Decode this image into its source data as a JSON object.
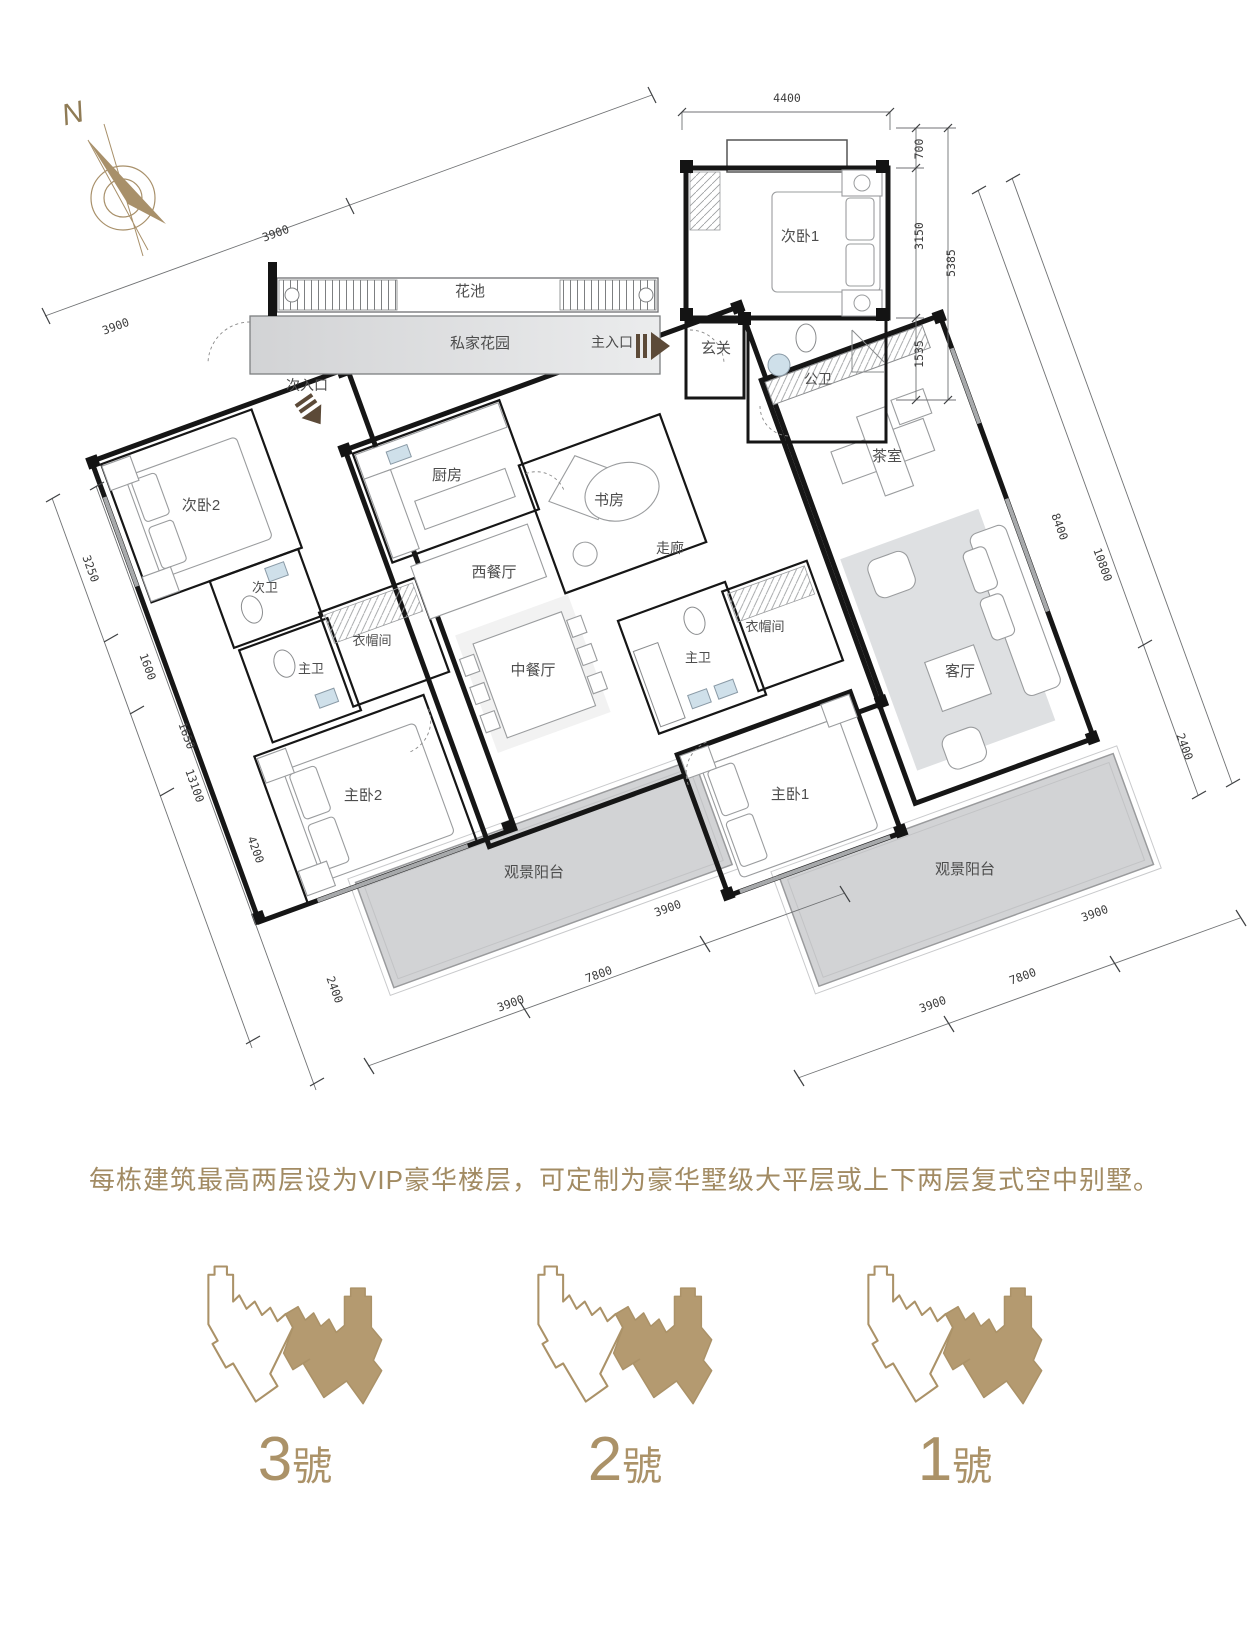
{
  "compass": {
    "label": "N"
  },
  "caption": "每栋建筑最高两层设为VIP豪华楼层，可定制为豪华墅级大平层或上下两层复式空中别墅。",
  "colors": {
    "accent_tan": "#ab9268",
    "entrance_arrow_brown": "#5c4a38",
    "bedroom_floor": "#d8d2c8",
    "bathroom_floor": "#c7cdd3",
    "closet_floor": "#cdc7bc",
    "common_floor": "#e6e7e9",
    "balcony_floor": "#d2d3d5",
    "wall": "#161616"
  },
  "plan": {
    "rooms": [
      {
        "t": "花池",
        "x": 470,
        "y": 296,
        "s": 15
      },
      {
        "t": "私家花园",
        "x": 480,
        "y": 348,
        "s": 15
      },
      {
        "t": "主入口",
        "x": 612,
        "y": 347,
        "s": 14
      },
      {
        "t": "次入口",
        "x": 307,
        "y": 390,
        "s": 14
      },
      {
        "t": "玄关",
        "x": 716,
        "y": 353,
        "s": 15
      },
      {
        "t": "次卧1",
        "x": 800,
        "y": 241,
        "s": 15
      },
      {
        "t": "公卫",
        "x": 818,
        "y": 384,
        "s": 14
      },
      {
        "t": "茶室",
        "x": 887,
        "y": 461,
        "s": 15
      },
      {
        "t": "厨房",
        "x": 447,
        "y": 480,
        "s": 15
      },
      {
        "t": "书房",
        "x": 609,
        "y": 505,
        "s": 15
      },
      {
        "t": "走廊",
        "x": 670,
        "y": 553,
        "s": 14
      },
      {
        "t": "西餐厅",
        "x": 494,
        "y": 577,
        "s": 15
      },
      {
        "t": "次卧2",
        "x": 201,
        "y": 510,
        "s": 15
      },
      {
        "t": "次卫",
        "x": 265,
        "y": 592,
        "s": 13
      },
      {
        "t": "主卫",
        "x": 311,
        "y": 673,
        "s": 13
      },
      {
        "t": "衣帽间",
        "x": 372,
        "y": 645,
        "s": 13
      },
      {
        "t": "中餐厅",
        "x": 533,
        "y": 675,
        "s": 15
      },
      {
        "t": "主卫",
        "x": 698,
        "y": 662,
        "s": 13
      },
      {
        "t": "衣帽间",
        "x": 765,
        "y": 631,
        "s": 13
      },
      {
        "t": "主卧2",
        "x": 363,
        "y": 800,
        "s": 15
      },
      {
        "t": "主卧1",
        "x": 790,
        "y": 799,
        "s": 15
      },
      {
        "t": "客厅",
        "x": 960,
        "y": 676,
        "s": 15
      },
      {
        "t": "观景阳台",
        "x": 534,
        "y": 877,
        "s": 15
      },
      {
        "t": "观景阳台",
        "x": 965,
        "y": 874,
        "s": 15
      }
    ],
    "dimensions": [
      {
        "t": "4400",
        "x": 787,
        "y": 102,
        "r": 0
      },
      {
        "t": "700",
        "x": 923,
        "y": 149,
        "r": -90
      },
      {
        "t": "3150",
        "x": 923,
        "y": 236,
        "r": -90
      },
      {
        "t": "5385",
        "x": 955,
        "y": 263,
        "r": -90
      },
      {
        "t": "1535",
        "x": 923,
        "y": 354,
        "r": -90
      },
      {
        "t": "3900",
        "x": 277,
        "y": 237,
        "r": -20
      },
      {
        "t": "3900",
        "x": 117,
        "y": 330,
        "r": -20
      },
      {
        "t": "3250",
        "x": 87,
        "y": 570,
        "r": 70
      },
      {
        "t": "1600",
        "x": 144,
        "y": 668,
        "r": 70
      },
      {
        "t": "1650",
        "x": 183,
        "y": 737,
        "r": 70
      },
      {
        "t": "13100",
        "x": 191,
        "y": 787,
        "r": 70
      },
      {
        "t": "4200",
        "x": 252,
        "y": 851,
        "r": 70
      },
      {
        "t": "2400",
        "x": 331,
        "y": 991,
        "r": 70
      },
      {
        "t": "3900",
        "x": 512,
        "y": 1007,
        "r": -20
      },
      {
        "t": "7800",
        "x": 600,
        "y": 978,
        "r": -20
      },
      {
        "t": "3900",
        "x": 669,
        "y": 912,
        "r": -20
      },
      {
        "t": "3900",
        "x": 934,
        "y": 1008,
        "r": -20
      },
      {
        "t": "7800",
        "x": 1024,
        "y": 980,
        "r": -20
      },
      {
        "t": "3900",
        "x": 1096,
        "y": 917,
        "r": -20
      },
      {
        "t": "8400",
        "x": 1056,
        "y": 528,
        "r": 70
      },
      {
        "t": "10800",
        "x": 1099,
        "y": 566,
        "r": 70
      },
      {
        "t": "2400",
        "x": 1181,
        "y": 748,
        "r": 70
      }
    ]
  },
  "buildings": [
    {
      "num": "3",
      "suffix": "號"
    },
    {
      "num": "2",
      "suffix": "號"
    },
    {
      "num": "1",
      "suffix": "號"
    }
  ]
}
